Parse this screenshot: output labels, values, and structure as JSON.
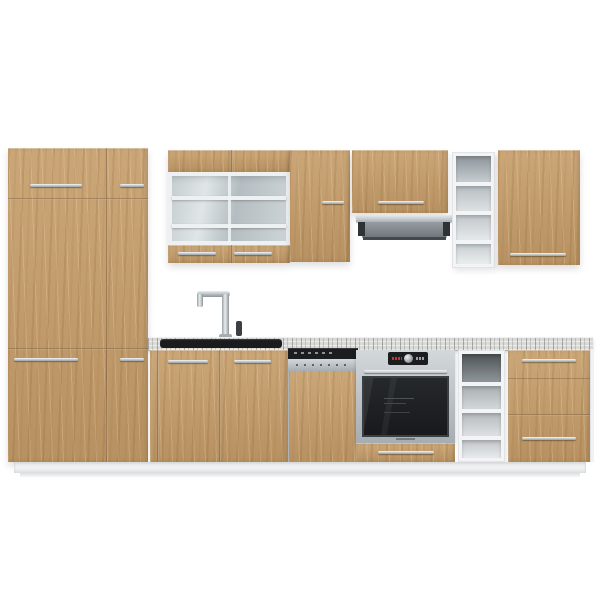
{
  "image_type": "product-photo",
  "subject": "Modern straight-run kitchen set with oak-effect fronts, white carcass, marble-effect worktop and built-in appliances",
  "palette": {
    "background": "#ffffff",
    "wood": "#c59c68",
    "wood-dark": "#8a6a42",
    "white-carcass": "#f3f4f5",
    "counter-light": "#d9d9d7",
    "counter-dark": "#8f8f8d",
    "steel": "#b9bec2",
    "steel-dark": "#878d91",
    "appliance-black": "#1b1d1f",
    "chrome": "#cfd4d7",
    "glass-tint": "#c6ced2"
  },
  "components": {
    "tall_cabinet": {
      "label": "Tall pantry cabinet with 4 doors",
      "handles": 4
    },
    "glass_wall_cabinet": {
      "label": "Wall display cabinet with glass doors",
      "shelves": 2
    },
    "wall_cabinet_left": {
      "label": "Wall cabinet"
    },
    "hood_cabinet": {
      "label": "Wall cabinet above extractor hood"
    },
    "range_hood": {
      "label": "Stainless under-cabinet extractor hood"
    },
    "wall_open_shelf": {
      "label": "Open wall shelf unit",
      "compartments": 4
    },
    "wall_cabinet_right": {
      "label": "Wall cabinet"
    },
    "countertop": {
      "label": "Marble-effect worktop"
    },
    "sink": {
      "label": "Inset black sink"
    },
    "faucet": {
      "label": "Chrome mixer tap"
    },
    "sink_base": {
      "label": "Sink base cabinet, 2 doors"
    },
    "dishwasher": {
      "label": "Semi-integrated dishwasher with furniture panel"
    },
    "oven": {
      "label": "Built-in stainless-steel oven"
    },
    "oven_drawer": {
      "label": "Drawer below oven"
    },
    "base_open_shelf": {
      "label": "Open base shelf unit",
      "compartments": 4
    },
    "drawer_unit": {
      "label": "Base cabinet with drawers",
      "drawers": 3
    },
    "plinth": {
      "label": "White plinth"
    }
  }
}
